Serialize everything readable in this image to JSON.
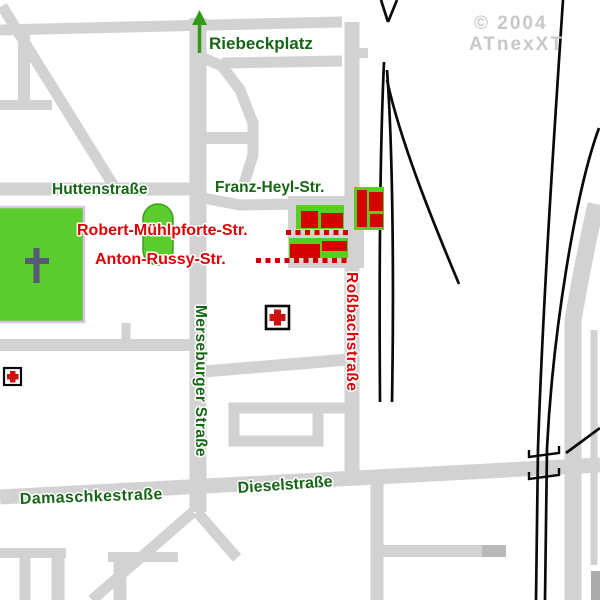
{
  "map": {
    "street_labels": {
      "riebeckplatz": "Riebeckplatz",
      "huttenstrasse": "Huttenstraße",
      "franz_heyl": "Franz-Heyl-Str.",
      "robert_muehlpforte": "Robert-Mühlpforte-Str.",
      "anton_russy": "Anton-Russy-Str.",
      "rossbachstrasse": "Roßbachstraße",
      "merseburger_strasse": "Merseburger Straße",
      "damaschkestrasse": "Damaschkestraße",
      "dieselstrasse": "Dieselstraße"
    },
    "watermark": {
      "line1": "© 2004",
      "line2": "ATnexXT"
    },
    "colors": {
      "street_gray": "#d2d2d2",
      "street_dark_gray": "#b9b9b9",
      "park_green": "#5bcb2d",
      "park_border_lavender": "#d9c4e6",
      "building_red": "#d50000",
      "building_outline_green": "#55d020",
      "label_green": "#176517",
      "label_red": "#dd0005",
      "arrow_green": "#349918",
      "railway_black": "#0a0a0a",
      "watermark_gray": "#c8c8c8",
      "cemetery_cross_slate": "#585878",
      "marker_cross_red": "#cc1111"
    },
    "icons": [
      {
        "name": "riebeckplatz-arrow-icon",
        "meaning": "direction arrow pointing north to Riebeckplatz"
      },
      {
        "name": "cemetery-cross-icon",
        "meaning": "cemetery / churchyard symbol in park"
      },
      {
        "name": "red-cross-marker",
        "meaning": "clinic / pharmacy location marker",
        "count": 2
      }
    ]
  }
}
